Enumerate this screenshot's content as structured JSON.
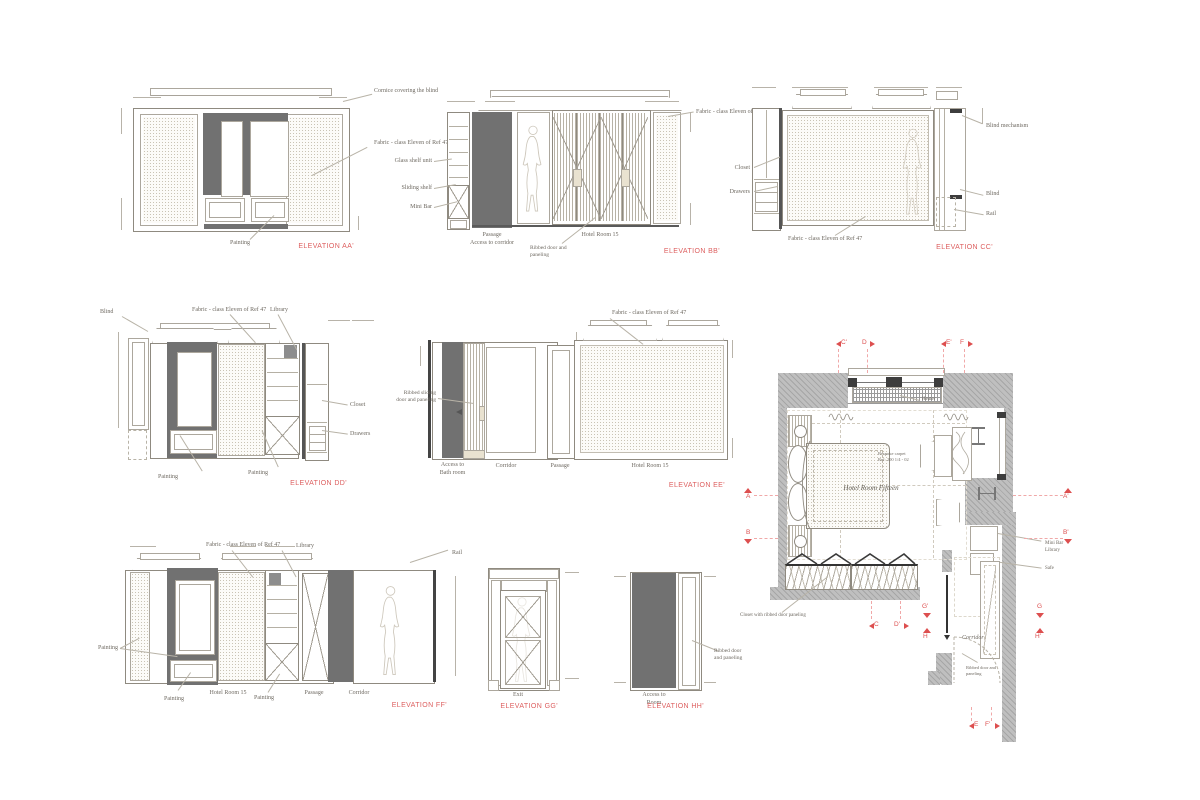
{
  "colors": {
    "accent_red": "#dd5f5f",
    "dark_fill": "#717171",
    "wall_gray": "#bfbfbf",
    "line": "#9a958c"
  },
  "elevations": {
    "aa": {
      "title": "ELEVATION AA'",
      "notes": {
        "cornice": "Cornice covering the blind",
        "fabric": "Fabric - class Eleven of Ref 47",
        "painting": "Painting"
      }
    },
    "bb": {
      "title": "ELEVATION BB'",
      "notes": {
        "glass_shelf": "Glass shelf unit",
        "sliding_shelf": "Sliding shelf",
        "mini_bar": "Mini Bar",
        "fabric": "Fabric - class Eleven of Ref 47",
        "ribbed": "Ribbed door and paneling"
      },
      "captions": {
        "passage": "Passage",
        "access": "Access to corridor",
        "room": "Hotel Room 15"
      }
    },
    "cc": {
      "title": "ELEVATION CC'",
      "notes": {
        "blind_mech": "Blind mechanism",
        "blind": "Blind",
        "rail": "Rail",
        "closet": "Closet",
        "drawers": "Drawers",
        "fabric": "Fabric - class Eleven of Ref 47"
      }
    },
    "dd": {
      "title": "ELEVATION DD'",
      "notes": {
        "fabric": "Fabric - class Eleven of Ref 47",
        "library": "Library",
        "blind": "Blind",
        "closet": "Closet",
        "drawers": "Drawers",
        "painting1": "Painting",
        "painting2": "Painting"
      }
    },
    "ee": {
      "title": "ELEVATION EE'",
      "notes": {
        "fabric": "Fabric - class Eleven of Ref 47",
        "ribbed": "Ribbed sliding door and paneling"
      },
      "captions": {
        "access": "Access to",
        "bath": "Bath room",
        "corridor": "Corridor",
        "passage": "Passage",
        "room": "Hotel Room 15"
      }
    },
    "ff": {
      "title": "ELEVATION FF'",
      "notes": {
        "fabric": "Fabric - class Eleven of Ref 47",
        "library": "Library",
        "rail": "Rail",
        "painting_left": "Painting",
        "painting1": "Painting",
        "painting2": "Painting"
      },
      "captions": {
        "room": "Hotel Room 15",
        "passage": "Passage",
        "corridor": "Corridor"
      }
    },
    "gg": {
      "title": "ELEVATION GG'",
      "captions": {
        "exit": "Exit"
      }
    },
    "hh": {
      "title": "ELEVATION HH'",
      "notes": {
        "ribbed": "Ribbed door and paneling"
      },
      "captions": {
        "access": "Access to",
        "room": "Room"
      }
    }
  },
  "plan": {
    "title": "Hotel Room Fifteen",
    "carpet_note_line1": "Bespoke carpet",
    "carpet_note_line2": "Ref: 200 1/4 - 02",
    "heater": "Heater",
    "corridor": "Corridor",
    "mini_bar": "Mini Bar",
    "library": "Library",
    "safe": "Safe",
    "closet_note": "Closet with ribbed door paneling",
    "ribbed_note": "Ribbed door and paneling",
    "markers": {
      "a": "A",
      "a_p": "A'",
      "b": "B",
      "b_p": "B'",
      "c": "C",
      "c_p": "C'",
      "d": "D",
      "d_p": "D'",
      "e": "E",
      "e_p": "E'",
      "f": "F",
      "f_p": "F'",
      "g": "G",
      "g_p": "G'",
      "h": "H",
      "h_p": "H'"
    }
  }
}
